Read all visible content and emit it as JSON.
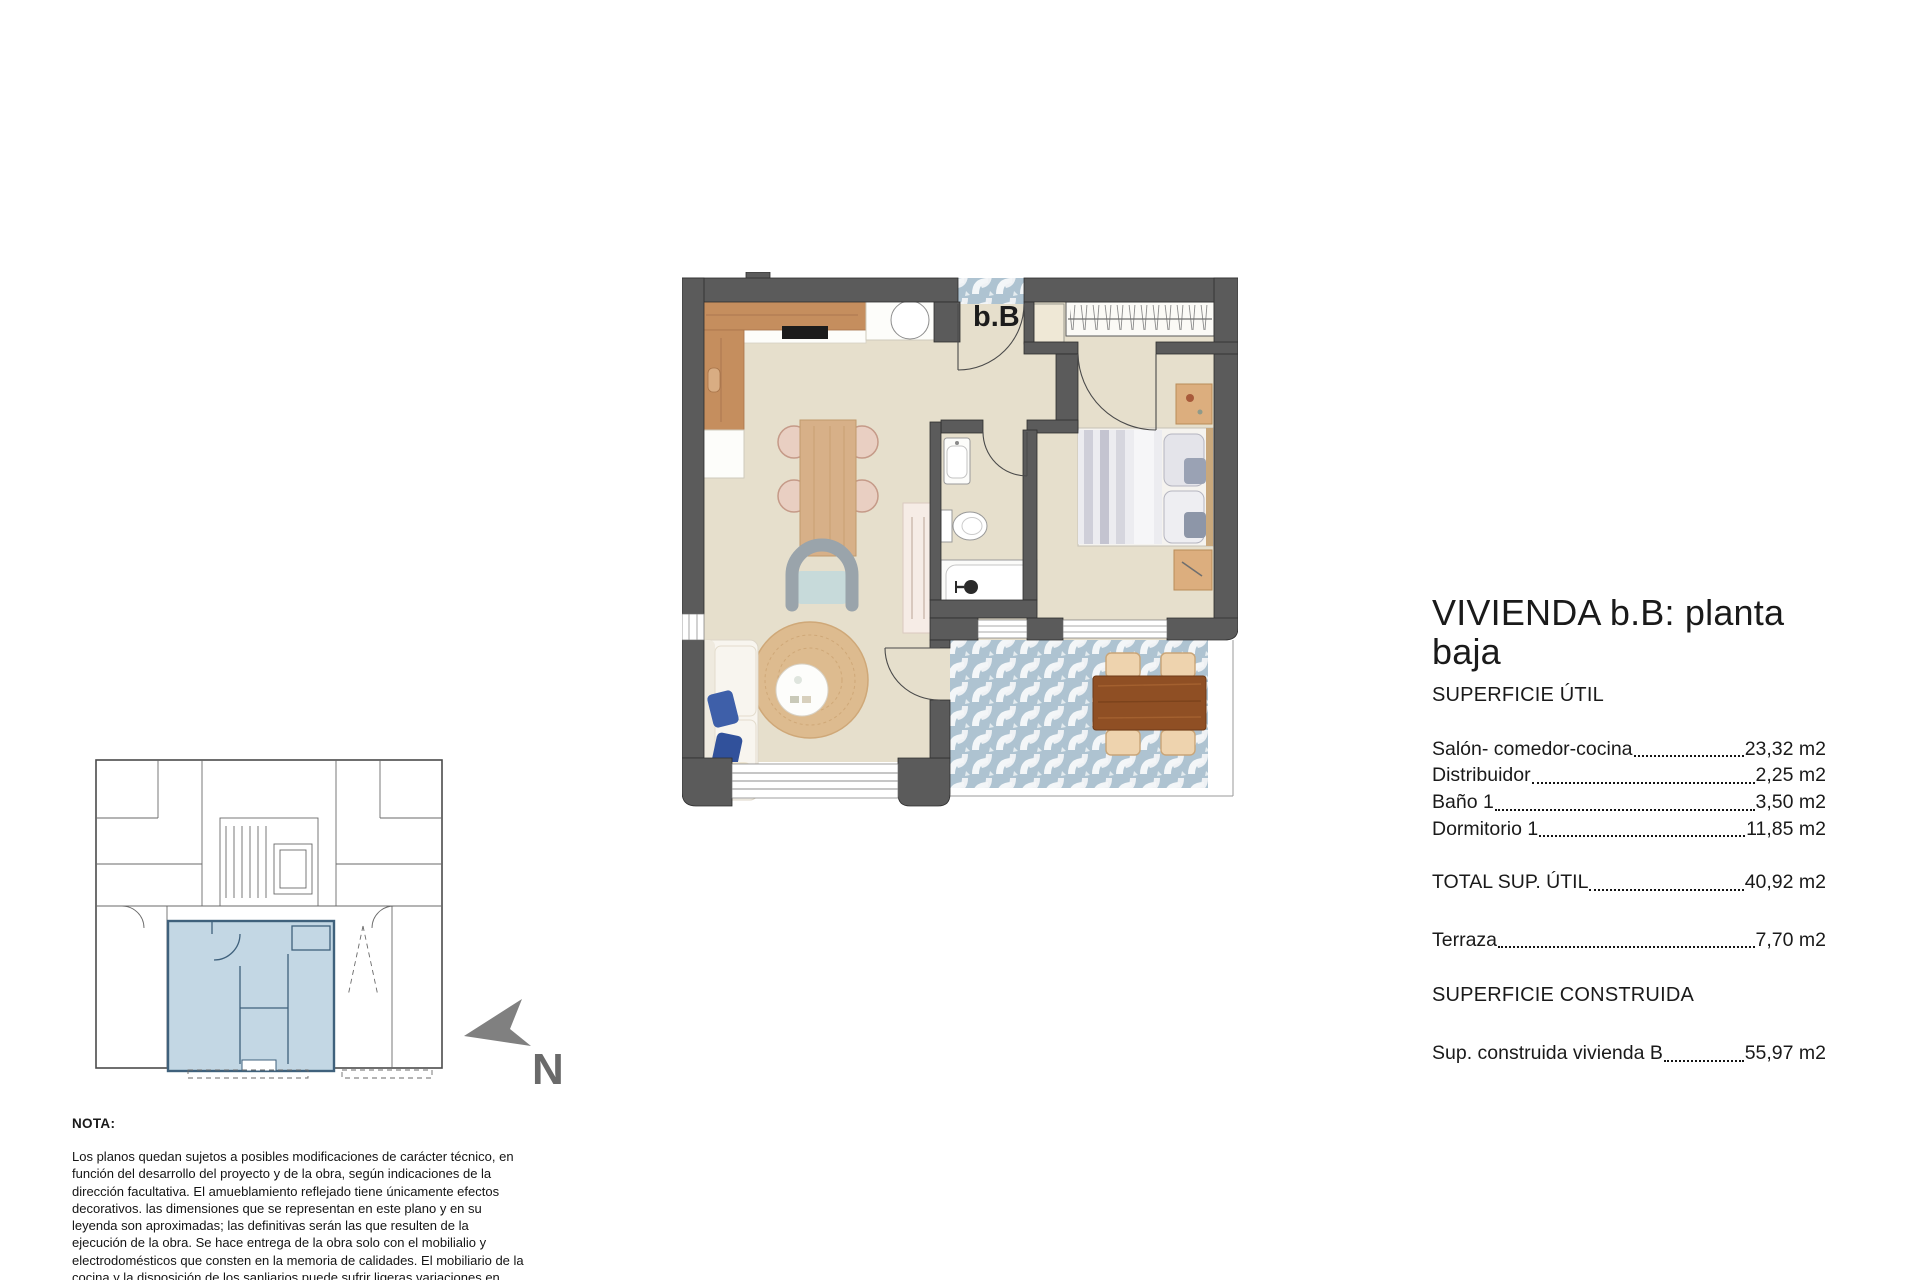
{
  "plan": {
    "unit_label": "b.B",
    "colors": {
      "wall": "#5b5b5b",
      "floor": "#e6dfcc",
      "terrace_tile": "#aec3d1",
      "kitchen_wood": "#c58e5e",
      "key_plan_highlight": "#c3d7e4"
    }
  },
  "north": {
    "label": "N"
  },
  "specs": {
    "title": "VIVIENDA b.B: planta baja",
    "section_util": "SUPERFICIE ÚTIL",
    "rows": [
      {
        "label": "Salón- comedor-cocina",
        "value": "23,32 m2"
      },
      {
        "label": "Distribuidor",
        "value": "2,25 m2"
      },
      {
        "label": "Baño 1",
        "value": "3,50 m2"
      },
      {
        "label": "Dormitorio 1",
        "value": "11,85 m2"
      }
    ],
    "total": {
      "label": "TOTAL SUP. ÚTIL",
      "value": "40,92 m2"
    },
    "terraza": {
      "label": "Terraza",
      "value": "7,70 m2"
    },
    "section_construida": "SUPERFICIE CONSTRUIDA",
    "construida": {
      "label": "Sup. construida vivienda B",
      "value": "55,97 m2"
    }
  },
  "nota": {
    "heading": "NOTA:",
    "body": "Los planos quedan sujetos a posibles modificaciones de carácter técnico, en función del desarrollo del proyecto y de la obra, según indicaciones de la dirección facultativa. El amueblamiento reflejado tiene únicamente efectos decorativos. las dimensiones que se representan en este plano y en su leyenda son aproximadas; las definitivas serán las que resulten de la ejecución de la obra. Se hace entrega de la obra solo con el mobilialio y electrodomésticos que consten en la memoria de calidades. El mobiliario de la cocina y la disposición de los sanliarios puede sufrir ligeras variaciones en función del montaje definitivo."
  }
}
